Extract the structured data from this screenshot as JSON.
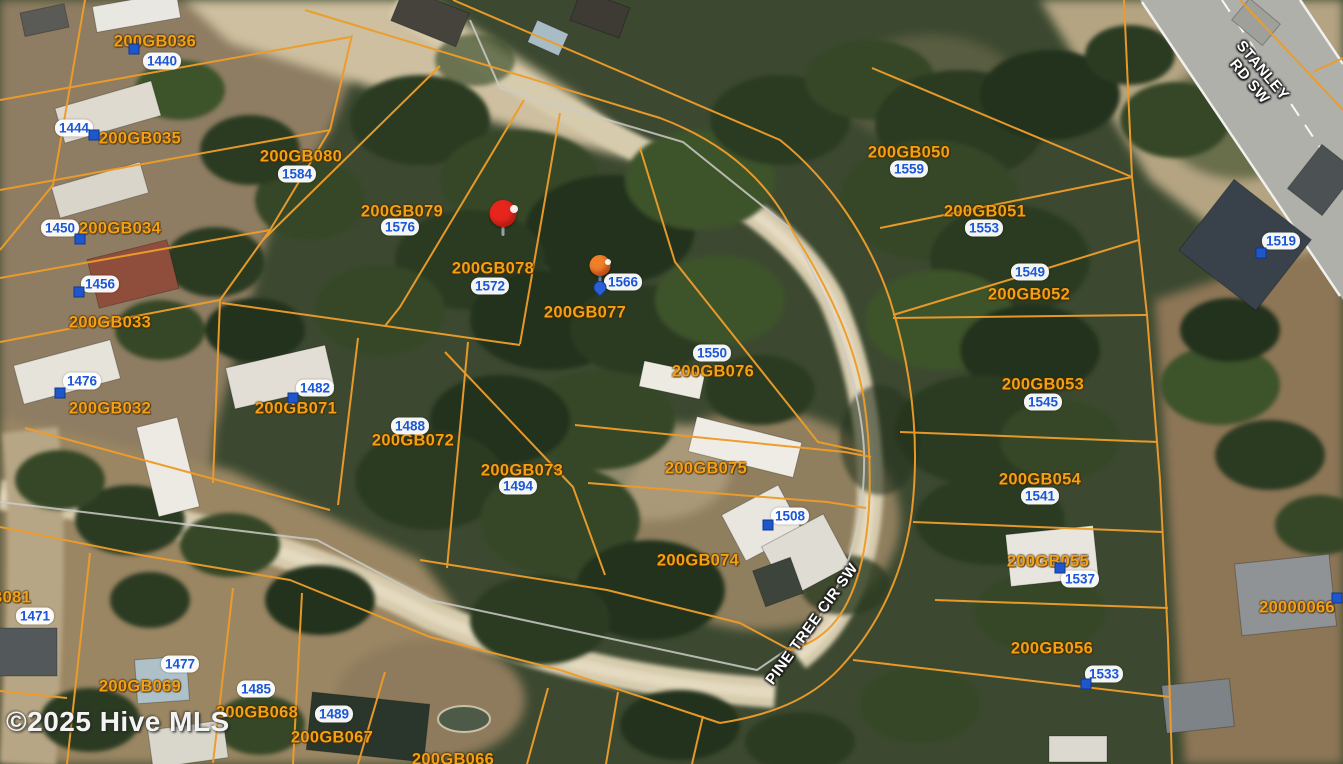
{
  "map": {
    "attribution": "©2025 Hive MLS",
    "colors": {
      "parcel_line": "#ed9c2a",
      "parcel_text": "#f3a013",
      "address_text": "#1a57d8",
      "house_marker": "#1e56cc",
      "road_label_text": "#ffffff",
      "pin_red": "#e8251d",
      "pin_orange": "#f07f2a",
      "pin_drop_blue": "#2a5fd6"
    },
    "road_labels": [
      {
        "name": "stanley-rd-sw",
        "lines": [
          "STANLEY",
          "RD SW"
        ],
        "x": 1256,
        "y": 76,
        "rotation": 50
      },
      {
        "name": "pine-tree-cir-sw",
        "lines": [
          "PINE TREE CIR SW"
        ],
        "x": 812,
        "y": 624,
        "rotation": -54
      }
    ],
    "parcels": [
      {
        "id": "200GB036",
        "x": 155,
        "y": 42
      },
      {
        "id": "200GB035",
        "x": 140,
        "y": 139
      },
      {
        "id": "200GB034",
        "x": 120,
        "y": 229
      },
      {
        "id": "200GB033",
        "x": 110,
        "y": 323
      },
      {
        "id": "200GB032",
        "x": 110,
        "y": 409
      },
      {
        "id": "200GB080",
        "x": 301,
        "y": 157
      },
      {
        "id": "200GB079",
        "x": 402,
        "y": 212
      },
      {
        "id": "200GB078",
        "x": 493,
        "y": 269
      },
      {
        "id": "200GB077",
        "x": 585,
        "y": 313
      },
      {
        "id": "200GB076",
        "x": 713,
        "y": 372
      },
      {
        "id": "200GB071",
        "x": 296,
        "y": 409
      },
      {
        "id": "200GB072",
        "x": 413,
        "y": 441
      },
      {
        "id": "200GB073",
        "x": 522,
        "y": 471
      },
      {
        "id": "200GB075",
        "x": 706,
        "y": 469
      },
      {
        "id": "200GB074",
        "x": 698,
        "y": 561
      },
      {
        "id": "200GB050",
        "x": 909,
        "y": 153
      },
      {
        "id": "200GB051",
        "x": 985,
        "y": 212
      },
      {
        "id": "200GB052",
        "x": 1029,
        "y": 295
      },
      {
        "id": "200GB053",
        "x": 1043,
        "y": 385
      },
      {
        "id": "200GB054",
        "x": 1040,
        "y": 480
      },
      {
        "id": "200GB055",
        "x": 1048,
        "y": 562
      },
      {
        "id": "200GB056",
        "x": 1052,
        "y": 649
      },
      {
        "id": "20000066",
        "x": 1297,
        "y": 608
      },
      {
        "id": "200GB081",
        "x": -10,
        "y": 598
      },
      {
        "id": "200GB069",
        "x": 140,
        "y": 687
      },
      {
        "id": "200GB068",
        "x": 257,
        "y": 713
      },
      {
        "id": "200GB067",
        "x": 332,
        "y": 738
      },
      {
        "id": "200GB066",
        "x": 453,
        "y": 760
      }
    ],
    "addresses": [
      {
        "num": "1440",
        "x": 162,
        "y": 61
      },
      {
        "num": "1444",
        "x": 74,
        "y": 128
      },
      {
        "num": "1450",
        "x": 60,
        "y": 228
      },
      {
        "num": "1456",
        "x": 100,
        "y": 284
      },
      {
        "num": "1476",
        "x": 82,
        "y": 381
      },
      {
        "num": "1482",
        "x": 315,
        "y": 388
      },
      {
        "num": "1488",
        "x": 410,
        "y": 426
      },
      {
        "num": "1494",
        "x": 518,
        "y": 486
      },
      {
        "num": "1584",
        "x": 297,
        "y": 174
      },
      {
        "num": "1576",
        "x": 400,
        "y": 227
      },
      {
        "num": "1572",
        "x": 490,
        "y": 286
      },
      {
        "num": "1566",
        "x": 623,
        "y": 282
      },
      {
        "num": "1550",
        "x": 712,
        "y": 353
      },
      {
        "num": "1508",
        "x": 790,
        "y": 516
      },
      {
        "num": "1559",
        "x": 909,
        "y": 169
      },
      {
        "num": "1553",
        "x": 984,
        "y": 228
      },
      {
        "num": "1549",
        "x": 1030,
        "y": 272
      },
      {
        "num": "1545",
        "x": 1043,
        "y": 402
      },
      {
        "num": "1541",
        "x": 1040,
        "y": 496
      },
      {
        "num": "1537",
        "x": 1080,
        "y": 579
      },
      {
        "num": "1533",
        "x": 1104,
        "y": 674
      },
      {
        "num": "1519",
        "x": 1281,
        "y": 241
      },
      {
        "num": "1471",
        "x": 35,
        "y": 616
      },
      {
        "num": "1477",
        "x": 180,
        "y": 664
      },
      {
        "num": "1485",
        "x": 256,
        "y": 689
      },
      {
        "num": "1489",
        "x": 334,
        "y": 714
      }
    ],
    "house_markers": [
      {
        "x": 134,
        "y": 49
      },
      {
        "x": 94,
        "y": 135
      },
      {
        "x": 80,
        "y": 239
      },
      {
        "x": 79,
        "y": 292
      },
      {
        "x": 60,
        "y": 393
      },
      {
        "x": 293,
        "y": 398
      },
      {
        "x": 768,
        "y": 525
      },
      {
        "x": 1261,
        "y": 253
      },
      {
        "x": 1060,
        "y": 568
      },
      {
        "x": 1086,
        "y": 684
      },
      {
        "x": 1337,
        "y": 598
      }
    ],
    "pins": [
      {
        "type": "red",
        "x": 503,
        "y": 214
      },
      {
        "type": "orange-blue",
        "x": 600,
        "y": 266
      }
    ]
  }
}
